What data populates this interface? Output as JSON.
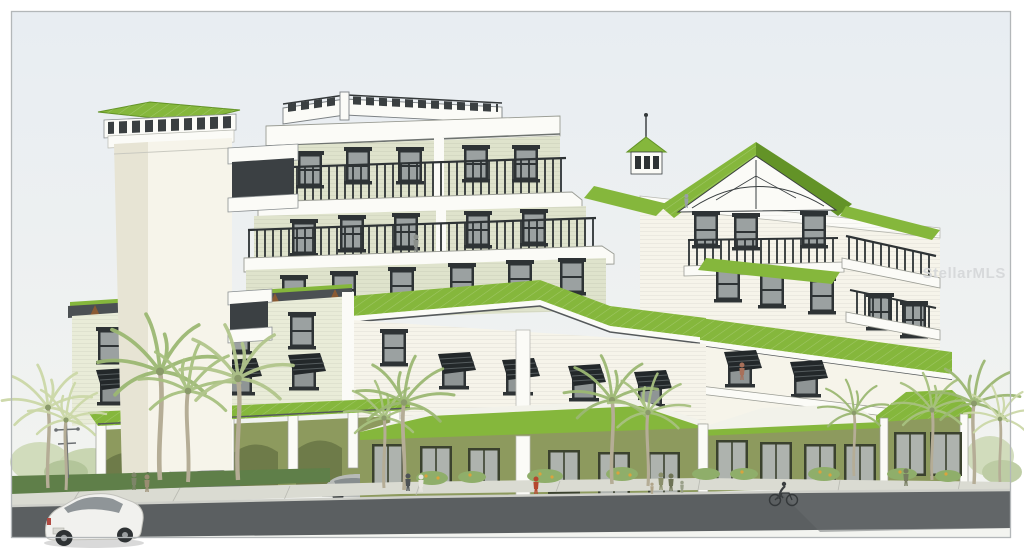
{
  "image": {
    "type": "architectural-rendering",
    "subject": "Six-story tropical condominium building with apple-green standing-seam metal roofs, white and sage siding, olive-green arcaded ground floor, bahama shutters, wraparound balconies, palm trees, pedestrians, a cyclist and cars along the street",
    "watermark": "StellarMLS"
  },
  "palette": {
    "sky_top": "#e8edf2",
    "sky_bottom": "#f3f4f0",
    "roof_green": "#85b73c",
    "roof_green_dark": "#639327",
    "wall_cream": "#f6f4ea",
    "wall_cream_shade": "#e7e4d4",
    "wall_sage": "#dfe3cc",
    "wall_siding": "#e9ecd8",
    "wall_olive": "#8d9a5e",
    "olive_dark": "#707c49",
    "trim_white": "#fbfbf7",
    "frame_dark": "#2e3335",
    "glass_gray": "#9ba1a1",
    "eave_charcoal": "#4b5053",
    "bracket_brown": "#8a5a33",
    "road_gray": "#5b5f61",
    "curb_light": "#cfd0ca",
    "sidewalk": "#dadbd2",
    "hedge_green": "#5f7f49",
    "bush_green": "#8fae6a",
    "flower_orange": "#daa33e",
    "palm_green": "#9cb873",
    "palm_pale": "#ccd8a8",
    "trunk_tan": "#b5ad96",
    "car_white": "#f1f1ee",
    "car_gray": "#b7bab7",
    "car_dark": "#676c6f",
    "watermark_gray": "#d6d8da",
    "border_gray": "#b3b7b9"
  }
}
